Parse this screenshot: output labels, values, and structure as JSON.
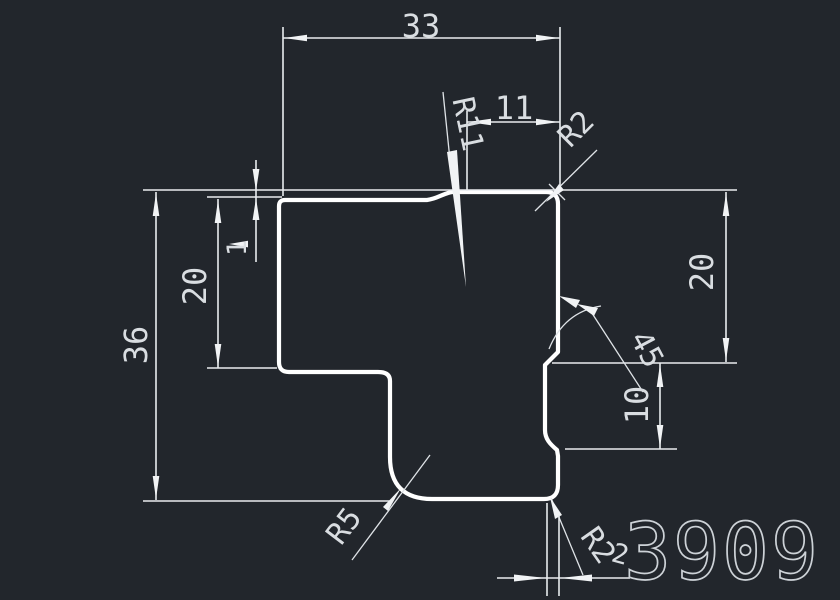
{
  "drawing": {
    "background_color": "#22262c",
    "outline_color": "#ffffff",
    "dimension_color": "#e9ecef",
    "part_number": "3909",
    "dimensions": {
      "top_width": "33",
      "raised_flat_width": "11",
      "top_blend_radius": "R11",
      "top_right_corner_radius": "R2",
      "step_height": "1",
      "left_arm_height": "20",
      "total_height": "36",
      "right_side_height": "20",
      "chamfer_angle": "45",
      "notch_height": "10",
      "bottom_left_radius": "R5",
      "bottom_right_corner_radius": "R2",
      "bottom_corner_width": "2"
    }
  }
}
